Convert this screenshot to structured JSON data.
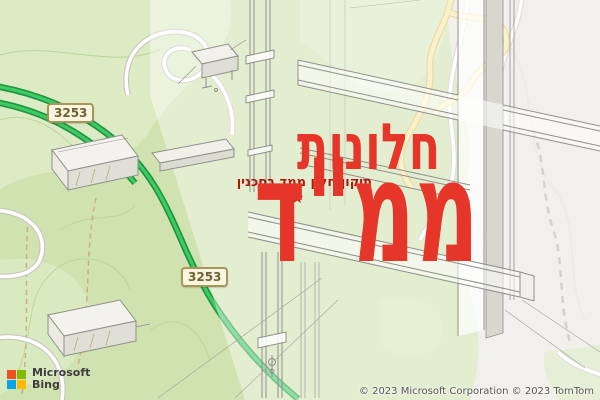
{
  "watermark": {
    "title_line1": "חלונות",
    "title_line2": "ממ\"ד",
    "subtitle": "תיקון חלון ממד בסכנין",
    "star_icon": "★",
    "accent_color": "#e63529"
  },
  "map": {
    "road_shields": [
      {
        "label": "3253"
      },
      {
        "label": "3253"
      }
    ],
    "attribution": "© 2023 Microsoft Corporation © 2023 TomTom",
    "logo": {
      "brand": "Microsoft",
      "product": "Bing"
    },
    "colors": {
      "park_green": "#cfe2b0",
      "urban_gray": "#e9e6df",
      "route_green": "#3fca63",
      "highway_yellow": "#f6e7a4",
      "shield_border": "#a8955a",
      "watermark_red": "#e63529"
    }
  },
  "overlay_drawing": {
    "description": "isometric technical drawing of safe-room window frame profiles"
  }
}
